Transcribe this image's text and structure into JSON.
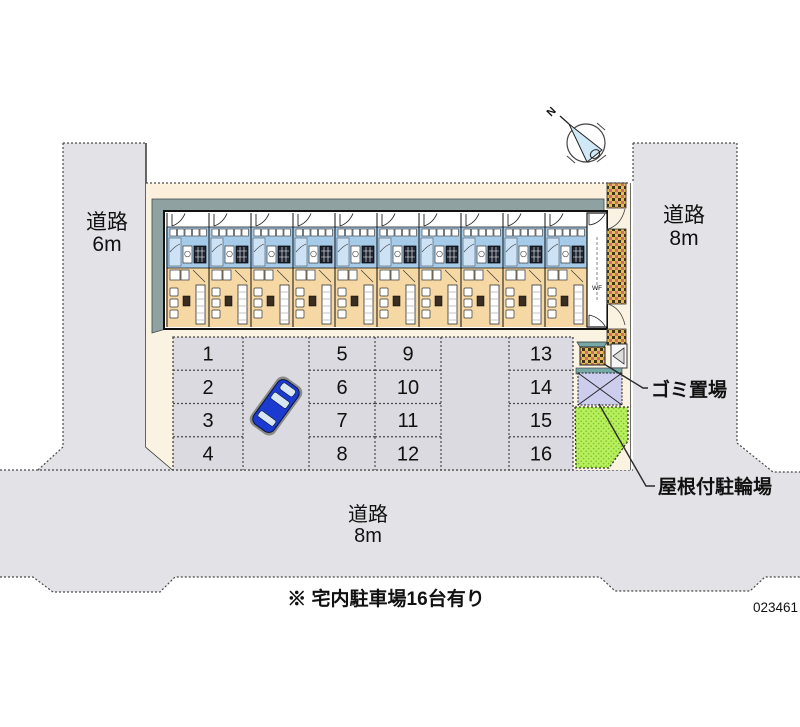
{
  "site": {
    "plan_number": "023461",
    "note": "※ 宅内駐車場16台有り"
  },
  "roads": {
    "left": {
      "label": "道路",
      "size": "6m"
    },
    "right": {
      "label": "道路",
      "size": "8m"
    },
    "bottom": {
      "label": "道路",
      "size": "8m"
    }
  },
  "annotations": {
    "garbage": "ゴミ置場",
    "bicycle": "屋根付駐輪場",
    "compass_north": "N",
    "stairwell": "WF"
  },
  "building": {
    "unit_count": 10
  },
  "parking": {
    "columns": [
      [
        "1",
        "2",
        "3",
        "4"
      ],
      [
        "5",
        "6",
        "7",
        "8"
      ],
      [
        "9",
        "10",
        "11",
        "12"
      ],
      [
        "13",
        "14",
        "15",
        "16"
      ]
    ],
    "total_spaces": 16
  },
  "colors": {
    "road": "#E3E2E6",
    "site": "#FAF3E1",
    "site_strip": "#FCEFDC",
    "band": "#8FA1A1",
    "unit_blue": "#A6CBE9",
    "unit_blue_light": "#CDE2F4",
    "unit_tan": "#F5D8A3",
    "parking": "#DBDAE0",
    "green": "#B8EF5C",
    "green_dot": "#7CC22E",
    "lavender": "#CDCDED",
    "brick_yellow": "#E2BF55",
    "brick_dark": "#403318",
    "brick_red": "#CF6A78",
    "teal_roof": "#76A8A8",
    "car_blue": "#1B3BD0",
    "compass_fill": "#CFE9F6"
  }
}
